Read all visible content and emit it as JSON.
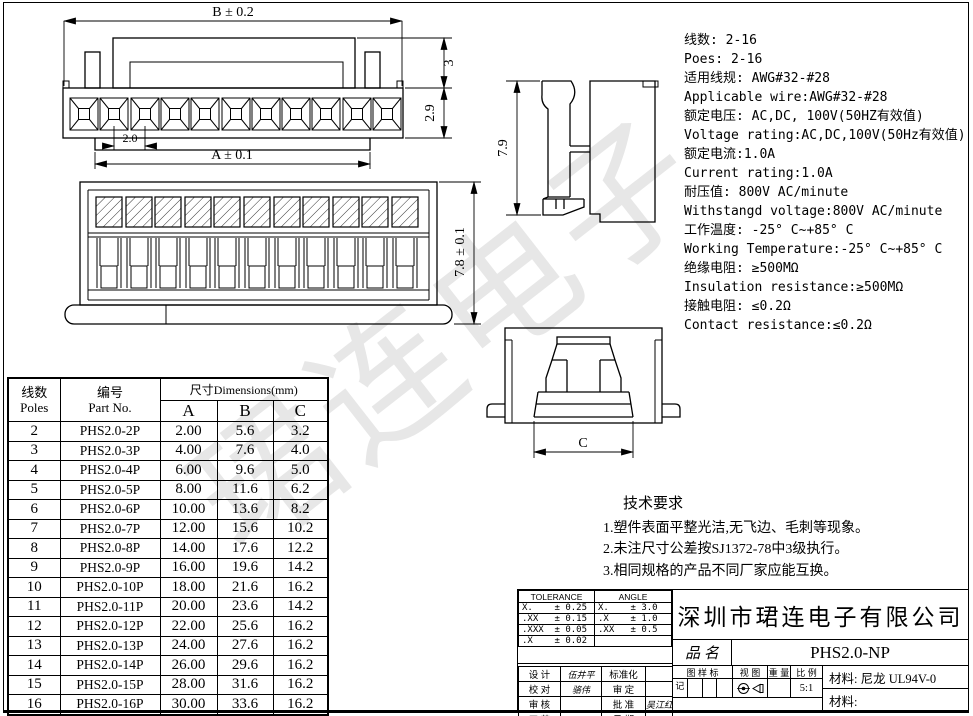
{
  "sheet": {
    "watermark": "珺连电子"
  },
  "drawing": {
    "front_view": {
      "dim_b": "B ± 0.2",
      "dim_a": "A ± 0.1",
      "dim_pitch": "2.0",
      "dim_back_height": "3",
      "dim_front_height": "2.9"
    },
    "rear_view": {
      "dim_height": "7.8 ± 0.1"
    },
    "side_view": {
      "dim_height": "7.9"
    },
    "end_view": {
      "dim_width": "C"
    }
  },
  "specs": {
    "lines": [
      "线数: 2-16",
      "Poes: 2-16",
      "适用线规: AWG#32-#28",
      "Applicable wire:AWG#32-#28",
      "额定电压: AC,DC, 100V(50HZ有效值)",
      "Voltage rating:AC,DC,100V(50Hz有效值)",
      "额定电流:1.0A",
      "Current rating:1.0A",
      "耐压值: 800V AC/minute",
      "Withstangd voltage:800V AC/minute",
      "工作温度: -25° C~+85° C",
      "Working Temperature:-25° C~+85° C",
      "绝缘电阻: ≥500MΩ",
      "Insulation resistance:≥500MΩ",
      "接触电阻: ≤0.2Ω",
      "Contact resistance:≤0.2Ω"
    ]
  },
  "dimensions_table": {
    "header": {
      "poles_cn": "线数",
      "poles_en": "Poles",
      "part_cn": "编号",
      "part_en": "Part No.",
      "dims_label": "尺寸Dimensions(mm)",
      "col_a": "A",
      "col_b": "B",
      "col_c": "C"
    },
    "rows": [
      {
        "poles": "2",
        "part": "PHS2.0-2P",
        "a": "2.00",
        "b": "5.6",
        "c": "3.2"
      },
      {
        "poles": "3",
        "part": "PHS2.0-3P",
        "a": "4.00",
        "b": "7.6",
        "c": "4.0"
      },
      {
        "poles": "4",
        "part": "PHS2.0-4P",
        "a": "6.00",
        "b": "9.6",
        "c": "5.0"
      },
      {
        "poles": "5",
        "part": "PHS2.0-5P",
        "a": "8.00",
        "b": "11.6",
        "c": "6.2"
      },
      {
        "poles": "6",
        "part": "PHS2.0-6P",
        "a": "10.00",
        "b": "13.6",
        "c": "8.2"
      },
      {
        "poles": "7",
        "part": "PHS2.0-7P",
        "a": "12.00",
        "b": "15.6",
        "c": "10.2"
      },
      {
        "poles": "8",
        "part": "PHS2.0-8P",
        "a": "14.00",
        "b": "17.6",
        "c": "12.2"
      },
      {
        "poles": "9",
        "part": "PHS2.0-9P",
        "a": "16.00",
        "b": "19.6",
        "c": "14.2"
      },
      {
        "poles": "10",
        "part": "PHS2.0-10P",
        "a": "18.00",
        "b": "21.6",
        "c": "16.2"
      },
      {
        "poles": "11",
        "part": "PHS2.0-11P",
        "a": "20.00",
        "b": "23.6",
        "c": "14.2"
      },
      {
        "poles": "12",
        "part": "PHS2.0-12P",
        "a": "22.00",
        "b": "25.6",
        "c": "16.2"
      },
      {
        "poles": "13",
        "part": "PHS2.0-13P",
        "a": "24.00",
        "b": "27.6",
        "c": "16.2"
      },
      {
        "poles": "14",
        "part": "PHS2.0-14P",
        "a": "26.00",
        "b": "29.6",
        "c": "16.2"
      },
      {
        "poles": "15",
        "part": "PHS2.0-15P",
        "a": "28.00",
        "b": "31.6",
        "c": "16.2"
      },
      {
        "poles": "16",
        "part": "PHS2.0-16P",
        "a": "30.00",
        "b": "33.6",
        "c": "16.2"
      }
    ]
  },
  "tech_requirements": {
    "title": "技术要求",
    "items": [
      "1.塑件表面平整光洁,无飞边、毛刺等现象。",
      "2.未注尺寸公差按SJ1372-78中3级执行。",
      "3.相同规格的产品不同厂家应能互换。"
    ]
  },
  "title_block": {
    "tolerance": {
      "header": "TOLERANCE",
      "rows": [
        "X.    ± 0.25",
        ".XX   ± 0.15",
        ".XXX  ± 0.05",
        ".X    ± 0.02"
      ]
    },
    "angle": {
      "header": "ANGLE",
      "rows": [
        "X.    ± 3.0",
        ".X    ± 1.0",
        ".XX   ± 0.5",
        ""
      ]
    },
    "signatures": {
      "rows": [
        [
          "设 计",
          "伍井平",
          "标准化",
          ""
        ],
        [
          "校 对",
          "骆伟",
          "审 定",
          ""
        ],
        [
          "审 核",
          "",
          "批 准",
          "吴江红"
        ],
        [
          "工 艺",
          "",
          "日 期",
          "2013.11.27"
        ]
      ]
    },
    "company": "深圳市珺连电子有限公司",
    "product_label": "品 名",
    "product_name": "PHS2.0-NP",
    "mark_label_top": "图 样 标",
    "mark_label_bottom": "记",
    "view_label": "视 图",
    "weight_label": "重 量",
    "scale_label": "比 例",
    "scale_value": "5:1",
    "material1": "材料: 尼龙 UL94V-0",
    "material2": "材料:"
  }
}
